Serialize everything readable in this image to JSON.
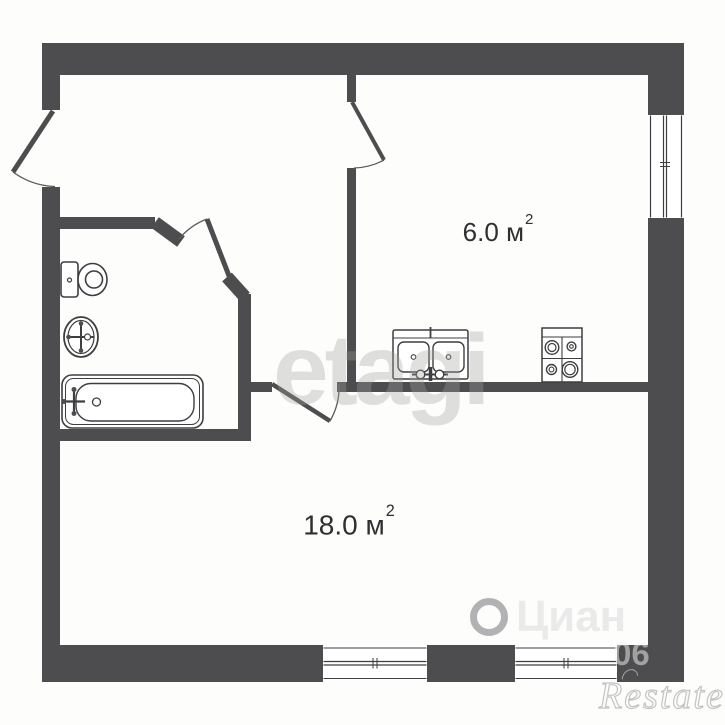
{
  "rooms": {
    "kitchen": {
      "name": "kitchen",
      "area_value": "6.0",
      "area_unit": "м",
      "area_sup": "2"
    },
    "living": {
      "name": "living-room",
      "area_value": "18.0",
      "area_unit": "м",
      "area_sup": "2"
    }
  },
  "watermarks": {
    "etagi": "etagi",
    "cian": "Циан",
    "phone_fragment": "06",
    "restate": "Restate"
  },
  "legend": {
    "fixtures": [
      "toilet",
      "wash-basin",
      "bathtub",
      "kitchen-sink",
      "stove"
    ],
    "doors": [
      "entry-door",
      "bathroom-door",
      "kitchen-door",
      "living-room-door"
    ],
    "windows": [
      "kitchen-window",
      "living-room-window-left",
      "living-room-window-right"
    ]
  },
  "colors": {
    "wall": "#4d4d4f",
    "line": "#3e3e41",
    "arc": "#5a5a5c",
    "label": "#2f2f31",
    "bg": "#fdfdfc"
  }
}
